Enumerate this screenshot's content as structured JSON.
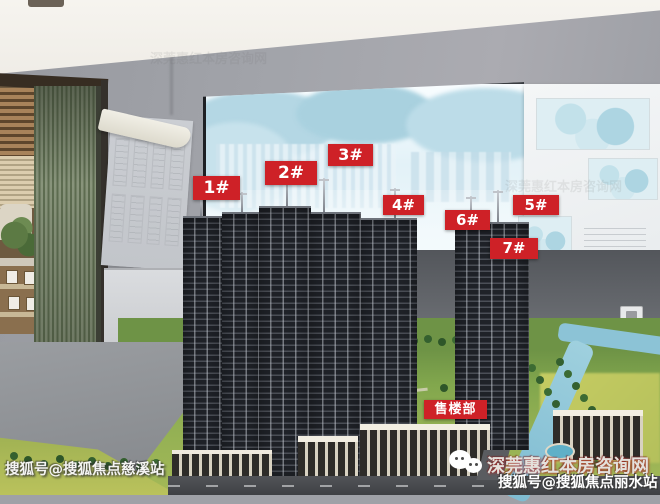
{
  "photo": {
    "tower_labels": [
      {
        "text": "1#"
      },
      {
        "text": "2#"
      },
      {
        "text": "3#"
      },
      {
        "text": "4#"
      },
      {
        "text": "5#"
      },
      {
        "text": "6#"
      },
      {
        "text": "7#"
      }
    ],
    "sales_office_label": "售楼部"
  },
  "watermarks": {
    "bottom_left": "搜狐号@搜狐焦点慈溪站",
    "bottom_right_line1": "深莞惠红本房咨询网",
    "bottom_right_line2": "搜狐号@搜狐焦点丽水站"
  },
  "colors": {
    "label_red": "#ce2127",
    "wall_gray": "#a2a4aa",
    "ceiling_white": "#f6f4ef",
    "screen_tint": "#e3f2f8",
    "partition_green": "#88947b",
    "tower_dark": "#1f2228",
    "model_green": "#93b054",
    "canal_blue": "#7fbcd2"
  }
}
